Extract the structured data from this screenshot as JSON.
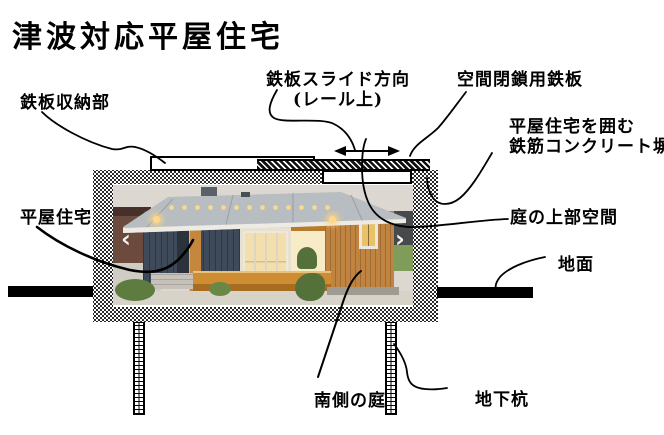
{
  "title": "津波対応平屋住宅",
  "labels": {
    "steel_plate_storage": "鉄板収納部",
    "slide_direction": "鉄板スライド方向",
    "slide_direction_sub": "(レール上)",
    "space_closing_plate": "空間閉鎖用鉄板",
    "surrounding_wall_line1": "平屋住宅を囲む",
    "surrounding_wall_line2": "鉄筋コンクリート塀",
    "flat_house": "平屋住宅",
    "garden_upper_space": "庭の上部空間",
    "ground_surface": "地面",
    "south_garden": "南側の庭",
    "underground_pile": "地下杭"
  },
  "photo_carousel": {
    "prev": "‹",
    "next": "›"
  },
  "colors": {
    "ink": "#000000",
    "house_navy": "#3e4a59",
    "house_orange": "#c08440",
    "roof_gray": "#b7bdc1",
    "deck_orange": "#c9862e",
    "warm_glow": "#f3dfae",
    "lawn_green": "#7f9c5b"
  }
}
